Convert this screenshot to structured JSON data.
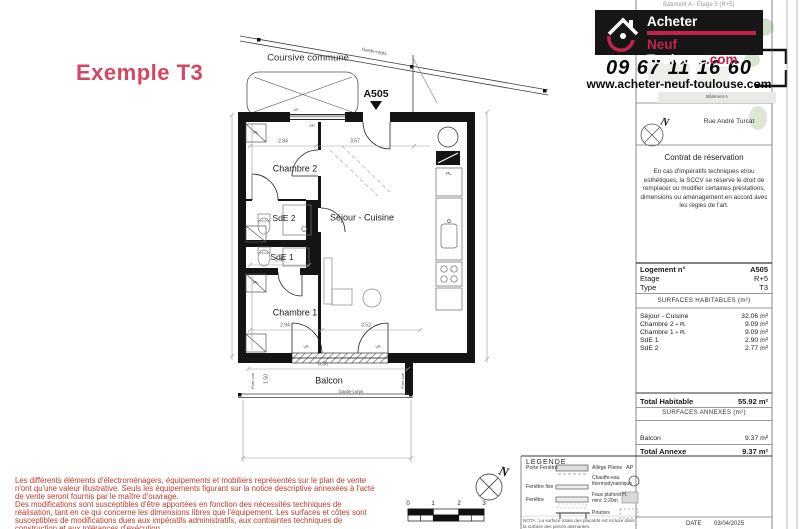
{
  "plan": {
    "title": "Exemple T3",
    "unit": "A505",
    "labels": {
      "coursive": "Coursive commune",
      "garde_corps": "Garde-corps",
      "pare_vue": "Pare-vue",
      "pl": "PL",
      "ap": "AP",
      "vr": "VR",
      "rooms": {
        "chambre2": "Chambre 2",
        "sde2": "SdE 2",
        "sde1": "SdE 1",
        "chambre1": "Chambre 1",
        "sejour": "Séjour - Cuisine",
        "balcon": "Balcon"
      }
    },
    "dims": {
      "chambre2_w": "2.84",
      "sejour_w": "3.67",
      "sde_w": "2.42",
      "chambre1_w": "2.94",
      "sejour_w2": "3.52",
      "balcon_w": "6.56",
      "balcon_d": "1.50"
    }
  },
  "header": {
    "cut_title": "Bâtiment A - Etage 5 (R+5)",
    "logo": {
      "line1": "Acheter",
      "neuf": "Neuf ",
      "toulouse": "Toulouse",
      "com": ".com"
    },
    "phone": "09 67 11 16 60",
    "website": "www.acheter-neuf-toulouse.com",
    "batiment": "Bâtiment A",
    "street": "Rue André Turcat"
  },
  "contract": {
    "title": "Contrat de réservation",
    "body": "En cas d'impératifs techniques et/ou esthétiques, la SCCV se réserve le droit de remplacer ou modifier certaines prestations, dimensions ou aménagement en accord avec les règles de l'art."
  },
  "table": {
    "info": [
      {
        "label": "Logement n°",
        "value": "A505"
      },
      {
        "label": "Etage",
        "value": "R+5"
      },
      {
        "label": "Type",
        "value": "T3"
      }
    ],
    "habitable_header": "SURFACES HABITABLES (m²)",
    "rows": [
      {
        "label": "Séjour - Cuisine",
        "suffix": "",
        "value": "32.06 m²"
      },
      {
        "label": "Chambre 2 ",
        "suffix": "+ PL",
        "value": "9.09 m²"
      },
      {
        "label": "Chambre 1 ",
        "suffix": "+ PL",
        "value": "9.09 m²"
      },
      {
        "label": "SdE 1",
        "suffix": "",
        "value": "2.90 m²"
      },
      {
        "label": "SdE 2",
        "suffix": "",
        "value": "2.77 m²"
      }
    ],
    "total_habitable": {
      "label": "Total Habitable",
      "value": "55.92 m²"
    },
    "annexe_header": "SURFACES ANNEXES (m²)",
    "annexe_row": {
      "label": "Balcon",
      "value": "9.37 m²"
    },
    "total_annexe": {
      "label": "Total Annexe",
      "value": "9.37 m²"
    },
    "date_label": "DATE",
    "date_value": "03/04/2025"
  },
  "legend": {
    "title": "LEGENDE",
    "left": [
      "Porte Fenêtre",
      "Fenêtre fixe",
      "Fenêtre"
    ],
    "right": [
      {
        "label": "Allège Pleine",
        "value": "AP"
      },
      {
        "label": "Chauffe-eau thermodynamique"
      },
      {
        "label": "Faux plafond H. mini: 2.20m"
      },
      {
        "label": "Poutres"
      }
    ],
    "nota": "NOTA : La surface totale des placards est incluse dans la surface des pièces attenantes."
  },
  "scalebar": [
    "0",
    "1",
    "2",
    "3"
  ],
  "disclaimer": {
    "p1": "Les différents éléments d'électroménagers, équipements et mobiliers représentés sur le plan de vente n'ont qu'une valeur illustrative. Seuls les équipements figurant sur la notice descriptive annexées à l'acte de vente seront fournis par le maître d'ouvrage.",
    "p2": "Des modifications sont susceptibles d'être apportées en fonction des nécessités techniques de réalisation, tant en ce qui concerne les dimensions libres que l'équipement. Les surfaces et côtes sont susceptibles de modifications dues aux impératifs administratifs, aux contraintes techniques de construction et aux tolérances d'exécution.",
    "color": "#c0392b"
  },
  "colors": {
    "accent_red": "#c4234e",
    "title_pink": "#d44762"
  }
}
